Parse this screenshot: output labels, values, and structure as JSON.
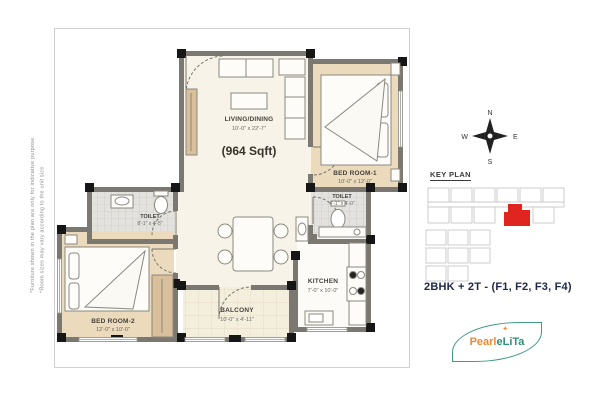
{
  "disclaimer": {
    "line1": "*Furniture shown in the plan are only for indicative purpose.",
    "line2": "*Room sizes may vary according to the unit size"
  },
  "plan": {
    "area": "(964 Sqft)",
    "rooms": {
      "living": {
        "name": "LIVING/DINING",
        "dims": "10'-0\" x 22'-7\""
      },
      "bedroom1": {
        "name": "BED ROOM-1",
        "dims": "10'-0\" x 12'-0\""
      },
      "toilet1": {
        "name": "TOILET",
        "dims": "4'-1\" x 4'-0\""
      },
      "toilet2": {
        "name": "TOILET",
        "dims": "8'-1\" x 4'-5\""
      },
      "bedroom2": {
        "name": "BED ROOM-2",
        "dims": "12'-0\" x 10'-0\""
      },
      "balcony": {
        "name": "BALCONY",
        "dims": "10'-0\" x 4'-11\""
      },
      "kitchen": {
        "name": "KITCHEN",
        "dims": "7'-0\" x 10'-0\""
      }
    }
  },
  "compass": {
    "n": "N",
    "e": "E",
    "s": "S",
    "w": "W"
  },
  "key_plan": {
    "title": "KEY PLAN",
    "highlight_color": "#e02420"
  },
  "unit_info": {
    "title": "2BHK + 2T - (F1, F2, F3, F4)"
  },
  "logo": {
    "word1": "Pearl",
    "word2": "eLiTa",
    "sparkle": "✦"
  },
  "colors": {
    "bedroom_floor": "#ecdabd",
    "living_floor": "#f8f3e9",
    "wall": "#7a7871",
    "accent_red": "#e02420",
    "logo_green": "#3f9b82",
    "logo_orange": "#ee8833"
  }
}
